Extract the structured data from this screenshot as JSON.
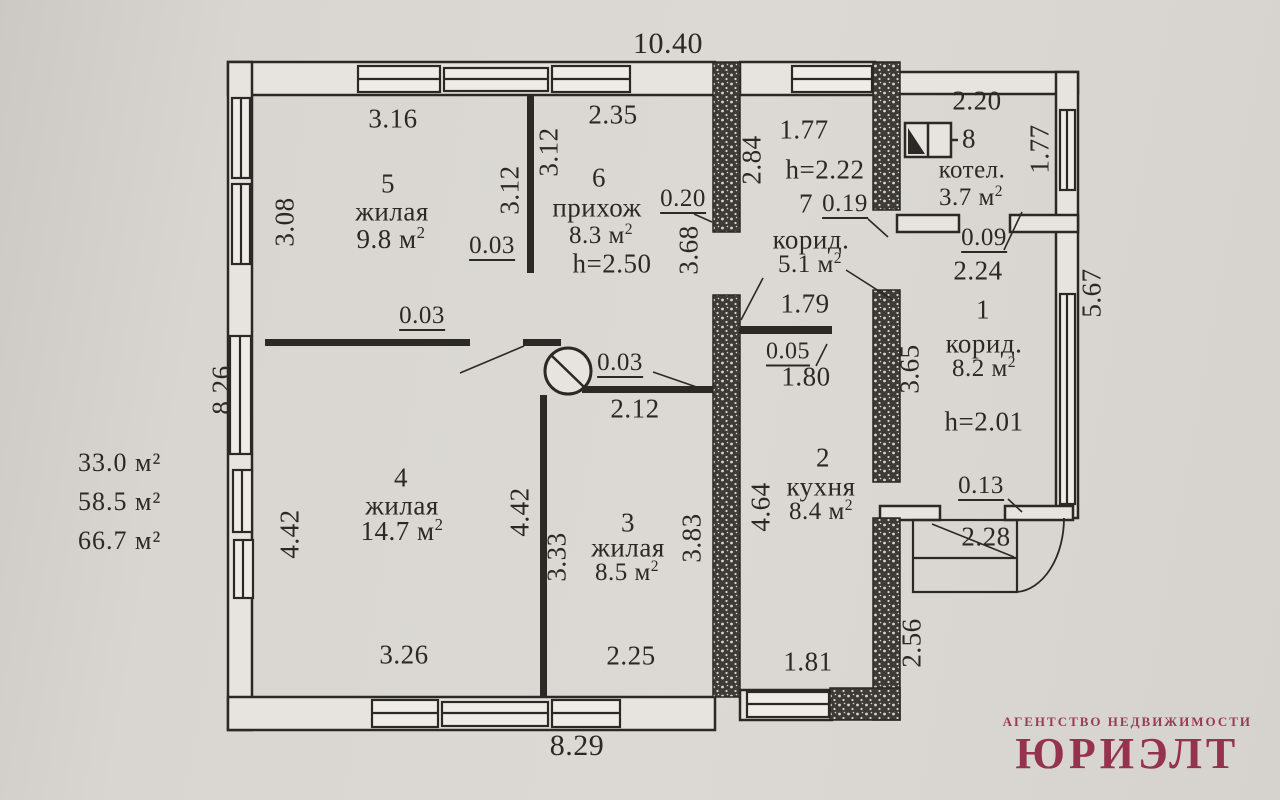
{
  "document": {
    "kind": "floor-plan scan",
    "language": "ru"
  },
  "colors": {
    "paper": "#d9d6d1",
    "ink": "#2b2925",
    "wall_fill": "#e7e4df",
    "logo_red": "#8e2140"
  },
  "logo": {
    "line1": "АГЕНТСТВО НЕДВИЖИМОСТИ",
    "line2": "ЮРИЭЛТ"
  },
  "totals": {
    "values": [
      "33.0 м²",
      "58.5 м²",
      "66.7 м²"
    ]
  },
  "overall_dimensions": {
    "top": "10.40",
    "bottom": "8.29",
    "left": "8.26",
    "right": "5.67",
    "bottom_right": "2.56"
  },
  "rooms": [
    {
      "number": "1",
      "name": "корид.",
      "area": "8.2 м²",
      "ceiling_height": "h=2.01"
    },
    {
      "number": "2",
      "name": "кухня",
      "area": "8.4 м²"
    },
    {
      "number": "3",
      "name": "жилая",
      "area": "8.5 м²"
    },
    {
      "number": "4",
      "name": "жилая",
      "area": "14.7 м²"
    },
    {
      "number": "5",
      "name": "жилая",
      "area": "9.8 м²"
    },
    {
      "number": "6",
      "name": "прихож",
      "area": "8.3 м²",
      "ceiling_height": "h=2.50"
    },
    {
      "number": "7",
      "name": "корид.",
      "area": "5.1 м²",
      "ceiling_height": "h=2.22"
    },
    {
      "number": "8",
      "name": "котел.",
      "area": "3.7 м²"
    }
  ],
  "icons": [
    {
      "name": "stove-icon",
      "desc": "circle with diagonal stroke (печь)"
    },
    {
      "name": "boiler-icon",
      "desc": "rectangle with filled triangle (котёл)"
    }
  ],
  "labels": [
    {
      "t": "10.40",
      "x": 668,
      "y": 44,
      "s": 30
    },
    {
      "t": "8.29",
      "x": 577,
      "y": 746,
      "s": 30
    },
    {
      "t": "8.26",
      "x": 222,
      "y": 390,
      "r": -90
    },
    {
      "t": "5.67",
      "x": 1092,
      "y": 293,
      "r": -90
    },
    {
      "t": "2.56",
      "x": 912,
      "y": 643,
      "r": -90
    },
    {
      "t": "3.16",
      "x": 393,
      "y": 119
    },
    {
      "t": "3.08",
      "x": 285,
      "y": 222,
      "r": -90
    },
    {
      "t": "5",
      "x": 388,
      "y": 184,
      "n": "room-5-number"
    },
    {
      "t": "жилая",
      "x": 392,
      "y": 212,
      "n": "room-5-name"
    },
    {
      "t": "9.8 м²",
      "x": 391,
      "y": 239,
      "n": "room-5-area"
    },
    {
      "t": "3.12",
      "x": 510,
      "y": 190,
      "r": -90
    },
    {
      "t": "3.12",
      "x": 549,
      "y": 152,
      "r": -90
    },
    {
      "t": "0.03",
      "x": 492,
      "y": 247,
      "u": true,
      "s": 25
    },
    {
      "t": "2.35",
      "x": 613,
      "y": 115
    },
    {
      "t": "6",
      "x": 599,
      "y": 178,
      "n": "room-6-number"
    },
    {
      "t": "прихож",
      "x": 597,
      "y": 208,
      "n": "room-6-name"
    },
    {
      "t": "8.3 м²",
      "x": 601,
      "y": 235,
      "s": 25,
      "n": "room-6-area"
    },
    {
      "t": "h=2.50",
      "x": 612,
      "y": 264,
      "n": "room-6-height"
    },
    {
      "t": "0.20",
      "x": 683,
      "y": 200,
      "u": true,
      "s": 25
    },
    {
      "t": "3.68",
      "x": 689,
      "y": 250,
      "r": -90
    },
    {
      "t": "2.84",
      "x": 752,
      "y": 160,
      "r": -90
    },
    {
      "t": "1.77",
      "x": 804,
      "y": 130
    },
    {
      "t": "h=2.22",
      "x": 825,
      "y": 170,
      "n": "room-7-height"
    },
    {
      "t": "7",
      "x": 806,
      "y": 204,
      "n": "room-7-number"
    },
    {
      "t": "0.19",
      "x": 845,
      "y": 205,
      "u": true,
      "s": 25
    },
    {
      "t": "корид.",
      "x": 811,
      "y": 240,
      "n": "room-7-name"
    },
    {
      "t": "5.1 м²",
      "x": 810,
      "y": 264,
      "s": 25,
      "n": "room-7-area"
    },
    {
      "t": "1.79",
      "x": 805,
      "y": 304
    },
    {
      "t": "2.20",
      "x": 977,
      "y": 101
    },
    {
      "t": "8",
      "x": 969,
      "y": 139,
      "n": "room-8-number"
    },
    {
      "t": "котел.",
      "x": 972,
      "y": 170,
      "s": 25,
      "n": "room-8-name"
    },
    {
      "t": "3.7 м²",
      "x": 971,
      "y": 197,
      "s": 25,
      "n": "room-8-area"
    },
    {
      "t": "1.77",
      "x": 1040,
      "y": 149,
      "r": -90
    },
    {
      "t": "0.09",
      "x": 984,
      "y": 239,
      "u": true,
      "s": 25
    },
    {
      "t": "2.24",
      "x": 978,
      "y": 271
    },
    {
      "t": "1",
      "x": 983,
      "y": 310,
      "n": "room-1-number"
    },
    {
      "t": "корид.",
      "x": 984,
      "y": 344,
      "n": "room-1-name"
    },
    {
      "t": "8.2 м²",
      "x": 984,
      "y": 368,
      "s": 25,
      "n": "room-1-area"
    },
    {
      "t": "h=2.01",
      "x": 984,
      "y": 422,
      "n": "room-1-height"
    },
    {
      "t": "3.65",
      "x": 910,
      "y": 369,
      "r": -90
    },
    {
      "t": "0.13",
      "x": 981,
      "y": 487,
      "u": true,
      "s": 25
    },
    {
      "t": "2.28",
      "x": 986,
      "y": 537
    },
    {
      "t": "0.05",
      "x": 788,
      "y": 353,
      "u": true,
      "s": 24
    },
    {
      "t": "1.80",
      "x": 806,
      "y": 377
    },
    {
      "t": "2",
      "x": 823,
      "y": 458,
      "n": "room-2-number"
    },
    {
      "t": "кухня",
      "x": 821,
      "y": 487,
      "n": "room-2-name"
    },
    {
      "t": "8.4 м²",
      "x": 821,
      "y": 511,
      "s": 25,
      "n": "room-2-area"
    },
    {
      "t": "4.64",
      "x": 761,
      "y": 507,
      "r": -90
    },
    {
      "t": "1.81",
      "x": 808,
      "y": 662
    },
    {
      "t": "0.03",
      "x": 422,
      "y": 317,
      "u": true,
      "s": 25
    },
    {
      "t": "0.03",
      "x": 620,
      "y": 364,
      "u": true,
      "s": 25
    },
    {
      "t": "2.12",
      "x": 635,
      "y": 409
    },
    {
      "t": "4",
      "x": 401,
      "y": 478,
      "n": "room-4-number"
    },
    {
      "t": "жилая",
      "x": 402,
      "y": 506,
      "n": "room-4-name"
    },
    {
      "t": "14.7 м²",
      "x": 402,
      "y": 531,
      "n": "room-4-area"
    },
    {
      "t": "4.42",
      "x": 290,
      "y": 534,
      "r": -90
    },
    {
      "t": "4.42",
      "x": 520,
      "y": 512,
      "r": -90
    },
    {
      "t": "3.26",
      "x": 404,
      "y": 655
    },
    {
      "t": "3",
      "x": 628,
      "y": 523,
      "n": "room-3-number"
    },
    {
      "t": "жилая",
      "x": 628,
      "y": 548,
      "n": "room-3-name"
    },
    {
      "t": "8.5 м²",
      "x": 627,
      "y": 572,
      "s": 25,
      "n": "room-3-area"
    },
    {
      "t": "3.33",
      "x": 557,
      "y": 557,
      "r": -90
    },
    {
      "t": "3.83",
      "x": 692,
      "y": 538,
      "r": -90
    },
    {
      "t": "2.25",
      "x": 631,
      "y": 656
    }
  ]
}
